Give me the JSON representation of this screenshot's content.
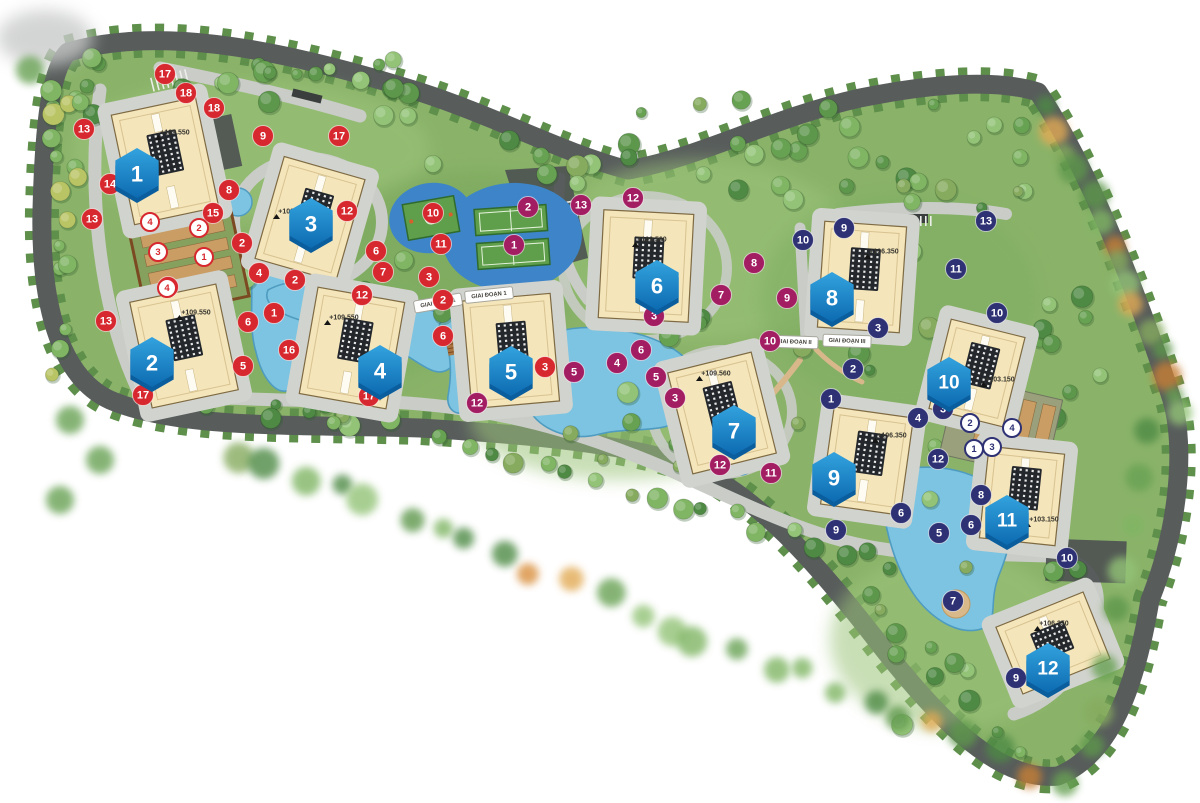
{
  "map": {
    "palette": {
      "bg": "#ffffff",
      "green_base": "#8ab369",
      "green_fringe": "#5e8f4b",
      "road_ring": "#585d5c",
      "road": "#c9ccc7",
      "road_dark": "#4e5352",
      "water": "#7cc4e2",
      "water_edge": "#4f9cc0",
      "court_blue": "#3d85c8",
      "court_green": "#5f9e4a",
      "court_line": "#e4f2dc",
      "building": "#f4e5ba",
      "building_edge": "#7e6a43",
      "pad": "#d1d3ce",
      "panel": "#24282c",
      "hex_top": "#33a3de",
      "hex_bottom": "#0d6bb1",
      "hex_shadow": "#0a5e9e",
      "badge_red": "#d7282f",
      "badge_magenta": "#a21d62",
      "badge_navy": "#2e3174",
      "sign_text": "#43403a",
      "label_text": "#37352e",
      "tan": "#c99d63",
      "brown": "#7c4a22"
    },
    "buildings": [
      {
        "number": "1",
        "elevation": "+109.550",
        "cx": 165,
        "cy": 161,
        "w": 86,
        "h": 112,
        "rot": -12,
        "hx": 137,
        "hy": 173,
        "lx": 175,
        "ly": 133
      },
      {
        "number": "2",
        "elevation": "+109.550",
        "cx": 184,
        "cy": 346,
        "w": 88,
        "h": 108,
        "rot": -12,
        "hx": 152,
        "hy": 362,
        "lx": 196,
        "ly": 313
      },
      {
        "number": "3",
        "elevation": "+109.550",
        "cx": 310,
        "cy": 219,
        "w": 84,
        "h": 106,
        "rot": 16,
        "hx": 311,
        "hy": 223,
        "lx": 293,
        "ly": 212
      },
      {
        "number": "4",
        "elevation": "+109.550",
        "cx": 352,
        "cy": 348,
        "w": 88,
        "h": 108,
        "rot": 10,
        "hx": 380,
        "hy": 370,
        "lx": 344,
        "ly": 318
      },
      {
        "number": "5",
        "elevation": "",
        "cx": 511,
        "cy": 351,
        "w": 88,
        "h": 108,
        "rot": -5,
        "hx": 511,
        "hy": 371,
        "lx": 0,
        "ly": 0
      },
      {
        "number": "6",
        "elevation": "+109.560",
        "cx": 646,
        "cy": 266,
        "w": 90,
        "h": 108,
        "rot": 3,
        "hx": 657,
        "hy": 285,
        "lx": 652,
        "ly": 240
      },
      {
        "number": "7",
        "elevation": "+109.560",
        "cx": 722,
        "cy": 413,
        "w": 86,
        "h": 104,
        "rot": -14,
        "hx": 734,
        "hy": 430,
        "lx": 716,
        "ly": 374
      },
      {
        "number": "8",
        "elevation": "+106.350",
        "cx": 862,
        "cy": 277,
        "w": 82,
        "h": 106,
        "rot": 4,
        "hx": 832,
        "hy": 297,
        "lx": 884,
        "ly": 252
      },
      {
        "number": "9",
        "elevation": "+106.350",
        "cx": 867,
        "cy": 461,
        "w": 80,
        "h": 98,
        "rot": 8,
        "hx": 834,
        "hy": 477,
        "lx": 892,
        "ly": 436
      },
      {
        "number": "10",
        "elevation": "+103.150",
        "cx": 977,
        "cy": 373,
        "w": 76,
        "h": 92,
        "rot": 14,
        "hx": 949,
        "hy": 382,
        "lx": 1000,
        "ly": 380
      },
      {
        "number": "11",
        "elevation": "+103.150",
        "cx": 1022,
        "cy": 496,
        "w": 76,
        "h": 92,
        "rot": 6,
        "hx": 1007,
        "hy": 520,
        "lx": 1044,
        "ly": 520
      },
      {
        "number": "12",
        "elevation": "+106.350",
        "cx": 1053,
        "cy": 643,
        "w": 94,
        "h": 72,
        "rot": -22,
        "hx": 1048,
        "hy": 668,
        "lx": 1054,
        "ly": 624
      }
    ],
    "phase_signs": [
      {
        "text": "GIAI ĐOẠN 1",
        "x": 438,
        "y": 303,
        "rot": -10
      },
      {
        "text": "GIAI ĐOẠN 1",
        "x": 489,
        "y": 295,
        "rot": -6
      },
      {
        "text": "GIAI ĐOẠN II",
        "x": 794,
        "y": 342,
        "rot": 2
      },
      {
        "text": "GIAI ĐOẠN III",
        "x": 847,
        "y": 341,
        "rot": 2
      }
    ],
    "badges": {
      "red": [
        {
          "n": "17",
          "x": 165,
          "y": 74
        },
        {
          "n": "18",
          "x": 186,
          "y": 93
        },
        {
          "n": "18",
          "x": 214,
          "y": 108
        },
        {
          "n": "13",
          "x": 84,
          "y": 129
        },
        {
          "n": "9",
          "x": 263,
          "y": 136
        },
        {
          "n": "17",
          "x": 339,
          "y": 136
        },
        {
          "n": "14",
          "x": 110,
          "y": 184
        },
        {
          "n": "8",
          "x": 229,
          "y": 190
        },
        {
          "n": "15",
          "x": 213,
          "y": 213
        },
        {
          "n": "12",
          "x": 347,
          "y": 211
        },
        {
          "n": "13",
          "x": 92,
          "y": 219
        },
        {
          "n": "10",
          "x": 433,
          "y": 213
        },
        {
          "n": "11",
          "x": 441,
          "y": 244
        },
        {
          "n": "2",
          "x": 242,
          "y": 243
        },
        {
          "n": "6",
          "x": 376,
          "y": 251
        },
        {
          "n": "7",
          "x": 383,
          "y": 272
        },
        {
          "n": "4",
          "x": 259,
          "y": 273
        },
        {
          "n": "3",
          "x": 429,
          "y": 277
        },
        {
          "n": "2",
          "x": 295,
          "y": 280
        },
        {
          "n": "4",
          "x": 168,
          "y": 287
        },
        {
          "n": "12",
          "x": 362,
          "y": 295
        },
        {
          "n": "2",
          "x": 443,
          "y": 300
        },
        {
          "n": "1",
          "x": 274,
          "y": 313
        },
        {
          "n": "13",
          "x": 106,
          "y": 321
        },
        {
          "n": "6",
          "x": 248,
          "y": 322
        },
        {
          "n": "6",
          "x": 443,
          "y": 336
        },
        {
          "n": "16",
          "x": 289,
          "y": 350
        },
        {
          "n": "5",
          "x": 243,
          "y": 366
        },
        {
          "n": "3",
          "x": 545,
          "y": 367
        },
        {
          "n": "17",
          "x": 143,
          "y": 395
        },
        {
          "n": "17",
          "x": 369,
          "y": 396
        }
      ],
      "magenta": [
        {
          "n": "13",
          "x": 581,
          "y": 205
        },
        {
          "n": "12",
          "x": 633,
          "y": 198
        },
        {
          "n": "2",
          "x": 528,
          "y": 207
        },
        {
          "n": "1",
          "x": 514,
          "y": 245
        },
        {
          "n": "8",
          "x": 754,
          "y": 263
        },
        {
          "n": "7",
          "x": 721,
          "y": 295
        },
        {
          "n": "9",
          "x": 787,
          "y": 298
        },
        {
          "n": "3",
          "x": 654,
          "y": 316
        },
        {
          "n": "10",
          "x": 770,
          "y": 341
        },
        {
          "n": "6",
          "x": 641,
          "y": 350
        },
        {
          "n": "4",
          "x": 617,
          "y": 363
        },
        {
          "n": "5",
          "x": 574,
          "y": 372
        },
        {
          "n": "5",
          "x": 656,
          "y": 377
        },
        {
          "n": "3",
          "x": 675,
          "y": 398
        },
        {
          "n": "12",
          "x": 477,
          "y": 403
        },
        {
          "n": "12",
          "x": 720,
          "y": 465
        },
        {
          "n": "11",
          "x": 771,
          "y": 473
        }
      ],
      "navy": [
        {
          "n": "9",
          "x": 844,
          "y": 228
        },
        {
          "n": "13",
          "x": 986,
          "y": 221
        },
        {
          "n": "10",
          "x": 803,
          "y": 240
        },
        {
          "n": "11",
          "x": 956,
          "y": 269
        },
        {
          "n": "10",
          "x": 997,
          "y": 313
        },
        {
          "n": "3",
          "x": 878,
          "y": 328
        },
        {
          "n": "2",
          "x": 853,
          "y": 369
        },
        {
          "n": "1",
          "x": 831,
          "y": 399
        },
        {
          "n": "3",
          "x": 943,
          "y": 409
        },
        {
          "n": "4",
          "x": 918,
          "y": 418
        },
        {
          "n": "12",
          "x": 938,
          "y": 459
        },
        {
          "n": "8",
          "x": 981,
          "y": 495
        },
        {
          "n": "6",
          "x": 901,
          "y": 513
        },
        {
          "n": "6",
          "x": 971,
          "y": 525
        },
        {
          "n": "9",
          "x": 836,
          "y": 530
        },
        {
          "n": "5",
          "x": 939,
          "y": 533
        },
        {
          "n": "10",
          "x": 1067,
          "y": 558
        },
        {
          "n": "7",
          "x": 953,
          "y": 601
        },
        {
          "n": "9",
          "x": 1016,
          "y": 678
        }
      ],
      "white_red": [
        {
          "n": "4",
          "x": 150,
          "y": 222
        },
        {
          "n": "2",
          "x": 199,
          "y": 228
        },
        {
          "n": "3",
          "x": 158,
          "y": 252
        },
        {
          "n": "1",
          "x": 204,
          "y": 257
        },
        {
          "n": "4",
          "x": 167,
          "y": 288
        }
      ],
      "white_navy": [
        {
          "n": "2",
          "x": 970,
          "y": 423
        },
        {
          "n": "4",
          "x": 1012,
          "y": 428
        },
        {
          "n": "1",
          "x": 974,
          "y": 449
        },
        {
          "n": "3",
          "x": 992,
          "y": 447
        }
      ]
    }
  }
}
